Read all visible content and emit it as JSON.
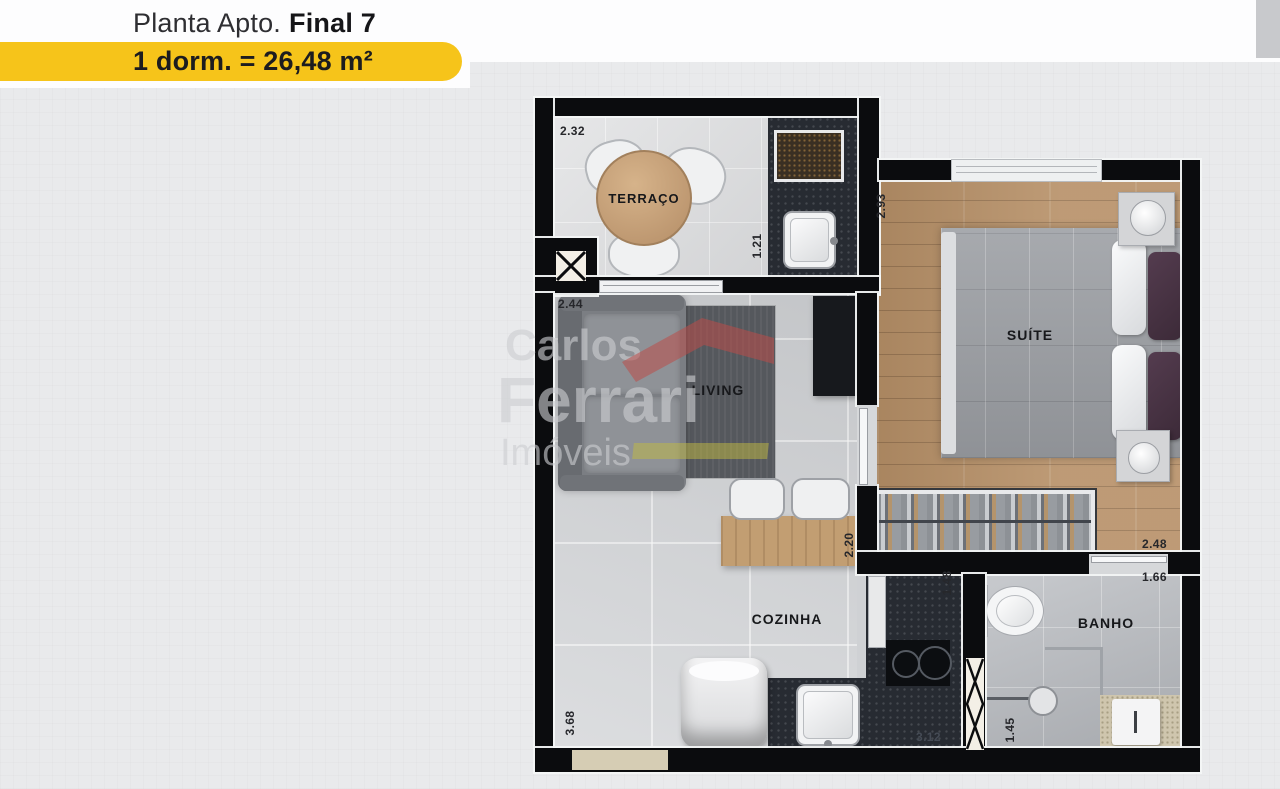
{
  "header": {
    "title_prefix": "Planta Apto.",
    "title_bold": "Final 7",
    "area_badge": "1 dorm. = 26,48 m²"
  },
  "watermark": {
    "line1": "Carlos",
    "line2": "Ferrari",
    "line3": "Imóveis"
  },
  "rooms": {
    "terraco": "TERRAÇO",
    "living": "LIVING",
    "suite": "SUÍTE",
    "cozinha": "COZINHA",
    "banho": "BANHO"
  },
  "dimensions": {
    "terraco_width": "2.32",
    "terraco_counter_depth": "1.21",
    "living_width": "2.44",
    "suite_depth": "2.93",
    "counter_length": "2.20",
    "suite_width": "2.48",
    "kitchen_length": "3.68",
    "kitchen_counter_depth": "1.48",
    "kitchen_width": "3.12",
    "banho_width": "1.66",
    "banho_depth": "1.45"
  },
  "colors": {
    "accent_yellow": "#F6C41A",
    "wall_black": "#0B0C0E",
    "wood_floor": "#B8926A",
    "granite": "#272B32",
    "watermark_red": "#BB4D48",
    "watermark_yellow": "#C1BA42"
  }
}
